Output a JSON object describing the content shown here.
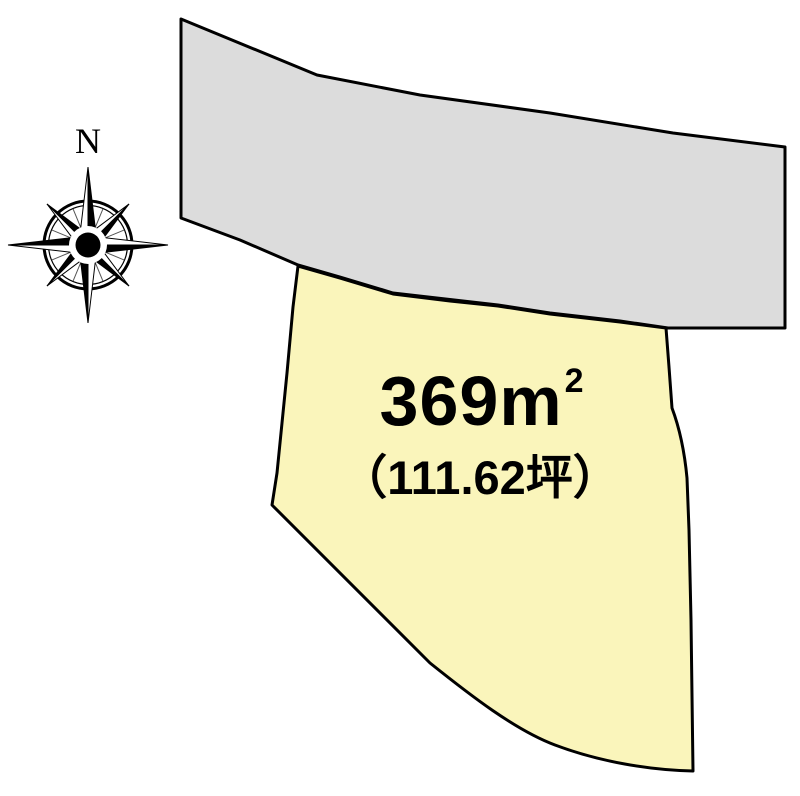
{
  "compass": {
    "north_label": "N"
  },
  "road": {
    "fill": "#dcdcdc",
    "stroke": "#000000"
  },
  "parcel": {
    "fill": "#faf5bb",
    "stroke": "#000000",
    "area_value": "369",
    "area_unit": "m",
    "area_exponent": "2",
    "area_tsubo": "（111.62坪）"
  }
}
